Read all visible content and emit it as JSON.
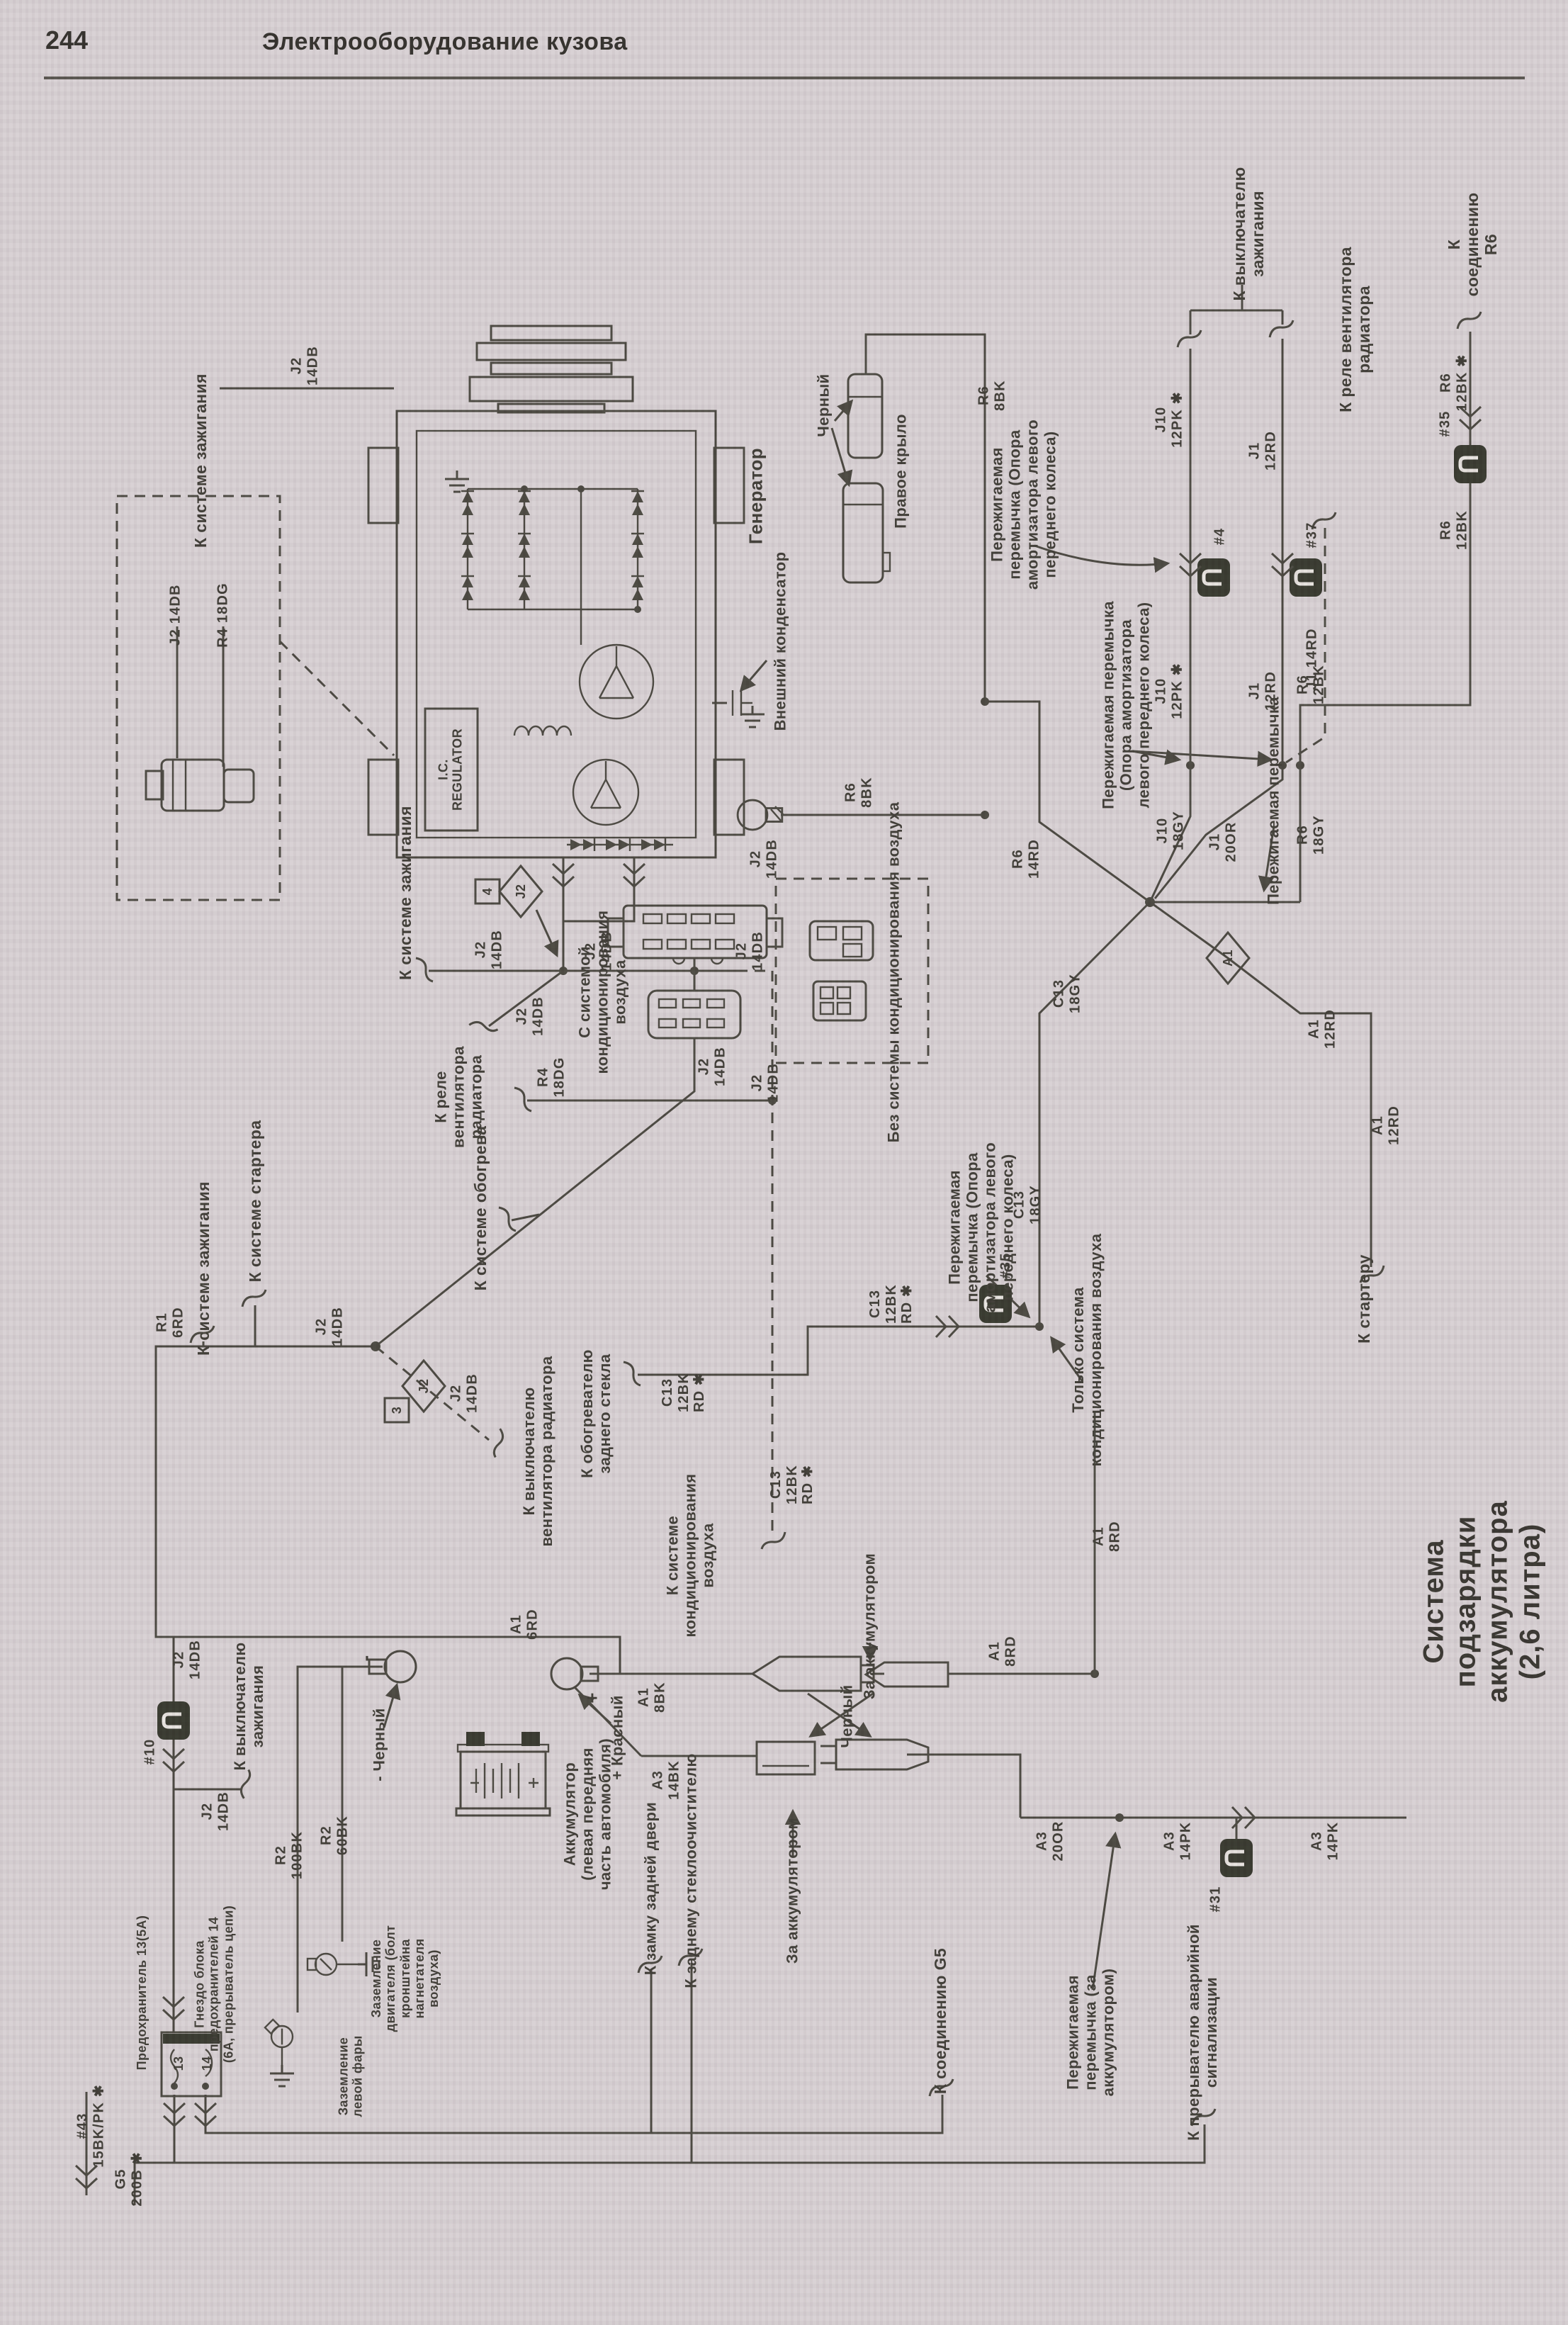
{
  "header": {
    "page_number": "244",
    "title": "Электрооборудование кузова"
  },
  "diagram_title": "Система подзарядки аккумулятора (2,6 литра)",
  "components": {
    "generator": "Генератор",
    "external_capacitor": "Внешний конденсатор",
    "right_fender": "Правое крыло",
    "black_top": "Черный",
    "black_links": "Черный",
    "black_minus": "- Черный",
    "red_plus": "+ Красный",
    "battery": "Аккумулятор\n(левая передняя\nчасть автомобиля)",
    "ic_regulator": "I.C.\nREGULATOR",
    "fuse_13": "Предохранитель 13(5А)",
    "fuse_socket_14": "Гнездо блока\nпредохранителей 14\n(6А, прерыватель цепи)",
    "engine_ground": "Заземление\nдвигателя (болт\nкронштейна\nнагнетателя\nвоздуха)",
    "headlight_ground": "Заземление\nлевой фары"
  },
  "destinations": {
    "to_ignition_switch_top": "К выключателю\nзажигания",
    "to_radiator_fan_relay_top": "К реле вентилятора радиатора",
    "to_connection_r6": "К соединению R6",
    "to_ignition_system_a": "К системе зажигания",
    "to_ignition_system_b": "К системе зажигания",
    "to_ignition_system_c": "К системе зажигания",
    "to_starter_system": "К системе стартера",
    "to_heating_system": "К системе обогрева",
    "to_radiator_fan_relay": "К реле\nвентилятора\nрадиатора",
    "to_radiator_fan_switch": "К выключателю\nвентилятора радиатора",
    "to_rear_window_defogger": "К обогревателю\nзаднего стекла",
    "to_ac_system": "К системе\nкондиционирования\nвоздуха",
    "to_starter": "К стартеру",
    "to_ignition_switch_bottom": "К выключателю\nзажигания",
    "to_rear_door_lock": "К замку задней двери",
    "to_rear_wiper": "К заднему стеклоочистителю",
    "behind_battery_1": "За аккумулятором",
    "behind_battery_2": "За аккумулятором",
    "to_connection_g5": "К соединению G5",
    "to_hazard_flasher": "К прерывателю аварийной\nсигнализации",
    "with_ac_system": "С системой\nкондиционирования\nвоздуха",
    "without_ac_system": "Без системы кондиционирования воздуха",
    "only_ac_system": "Только система\nкондиционирования воздуха"
  },
  "notes": {
    "fusible_link_strut_1": "Пережигаемая\nперемычка (Опора\nамортизатора левого\nпереднего колеса)",
    "fusible_link_strut_2": "Пережигаемая перемычка\n(Опора амортизатора\nлевого переднего колеса)",
    "fusible_link_plain": "Пережигаемая перемычка",
    "fusible_link_strut_3": "Пережигаемая\nперемычка (Опора\nамортизатора левого\nпереднего колеса)",
    "fusible_link_behind_battery": "Пережигаемая\nперемычка (за\nаккумулятором)"
  },
  "wires": {
    "inset_j2": "J2 14DB",
    "inset_r4": "R4 18DG",
    "j2_top": "J2\n14DB",
    "j2_a": "J2\n14DB",
    "j2_b": "J2\n14DB",
    "j2_c": "J2\n14DB",
    "j2_d": "J2\n14DB",
    "j2_e": "J2\n14DB",
    "j2_f": "J2\n14DB",
    "j2_g": "J2\n14DB",
    "j2_h": "J2\n14DB",
    "j2_i": "J2\n14DB",
    "j2_j": "J2\n14DB",
    "j2_k": "J2\n14DB",
    "r4_18dg": "R4\n18DG",
    "r1_6rd": "R1\n6RD",
    "a1_6rd": "A1\n6RD",
    "r6_8bk_a": "R6\n8BK",
    "r6_8bk_b": "R6\n8BK",
    "r6_14rd": "R6\n14RD",
    "j10_18gy": "J10\n18GY",
    "j10_12pk_a": "J10\n12PK ✱",
    "j10_12pk_b": "J10\n12PK ✱",
    "j1_12rd_a": "J1\n12RD",
    "j1_12rd_b": "J1\n12RD",
    "j1_20or": "J1\n20OR",
    "j1_14rd": "J1 14RD",
    "r6_12bk_star": "R6\n12BK ✱",
    "r6_12bk_a": "R6\n12BK",
    "r6_12bk_b": "R6\n12BK",
    "r6_18gy": "R6\n18GY",
    "c13_18gy_a": "C13\n18GY",
    "c13_18gy_b": "C13\n18GY",
    "c13_bkrd_a": "C13\n12BK\nRD ✱",
    "c13_bkrd_b": "C13\n12BK\nRD ✱",
    "c13_bkrd_c": "C13\n12BK\nRD ✱",
    "a1_8rd_a": "A1\n8RD",
    "a1_8rd_b": "A1\n8RD",
    "a1_8bk": "A1\n8BK",
    "a3_14bk": "A3\n14BK",
    "a3_20or": "A3\n20OR",
    "a3_14pk_a": "A3\n14PK",
    "a3_14pk_b": "A3\n14PK",
    "a1_12rd_a": "A1\n12RD",
    "a1_12rd_b": "A1\n12RD",
    "r2_100bk": "R2\n100BK",
    "r2_60bk": "R2\n60BK",
    "g5_200b": "G5\n200B ✱",
    "cb_43": "#43\n15BK/PK ✱"
  },
  "connectors": {
    "c4": "#4",
    "c37": "#37",
    "c35_top": "#35",
    "c35_mid": "#35",
    "c10": "#10",
    "c31": "#31",
    "diamond_j2_a": "J2",
    "diamond_j2_a_num": "4",
    "diamond_j2_b": "J2",
    "diamond_j2_b_num": "3",
    "diamond_a1": "A1",
    "fuse_pos_13": "13",
    "fuse_pos_14": "14",
    "plus_sign": "+",
    "minus_sign": "-"
  }
}
